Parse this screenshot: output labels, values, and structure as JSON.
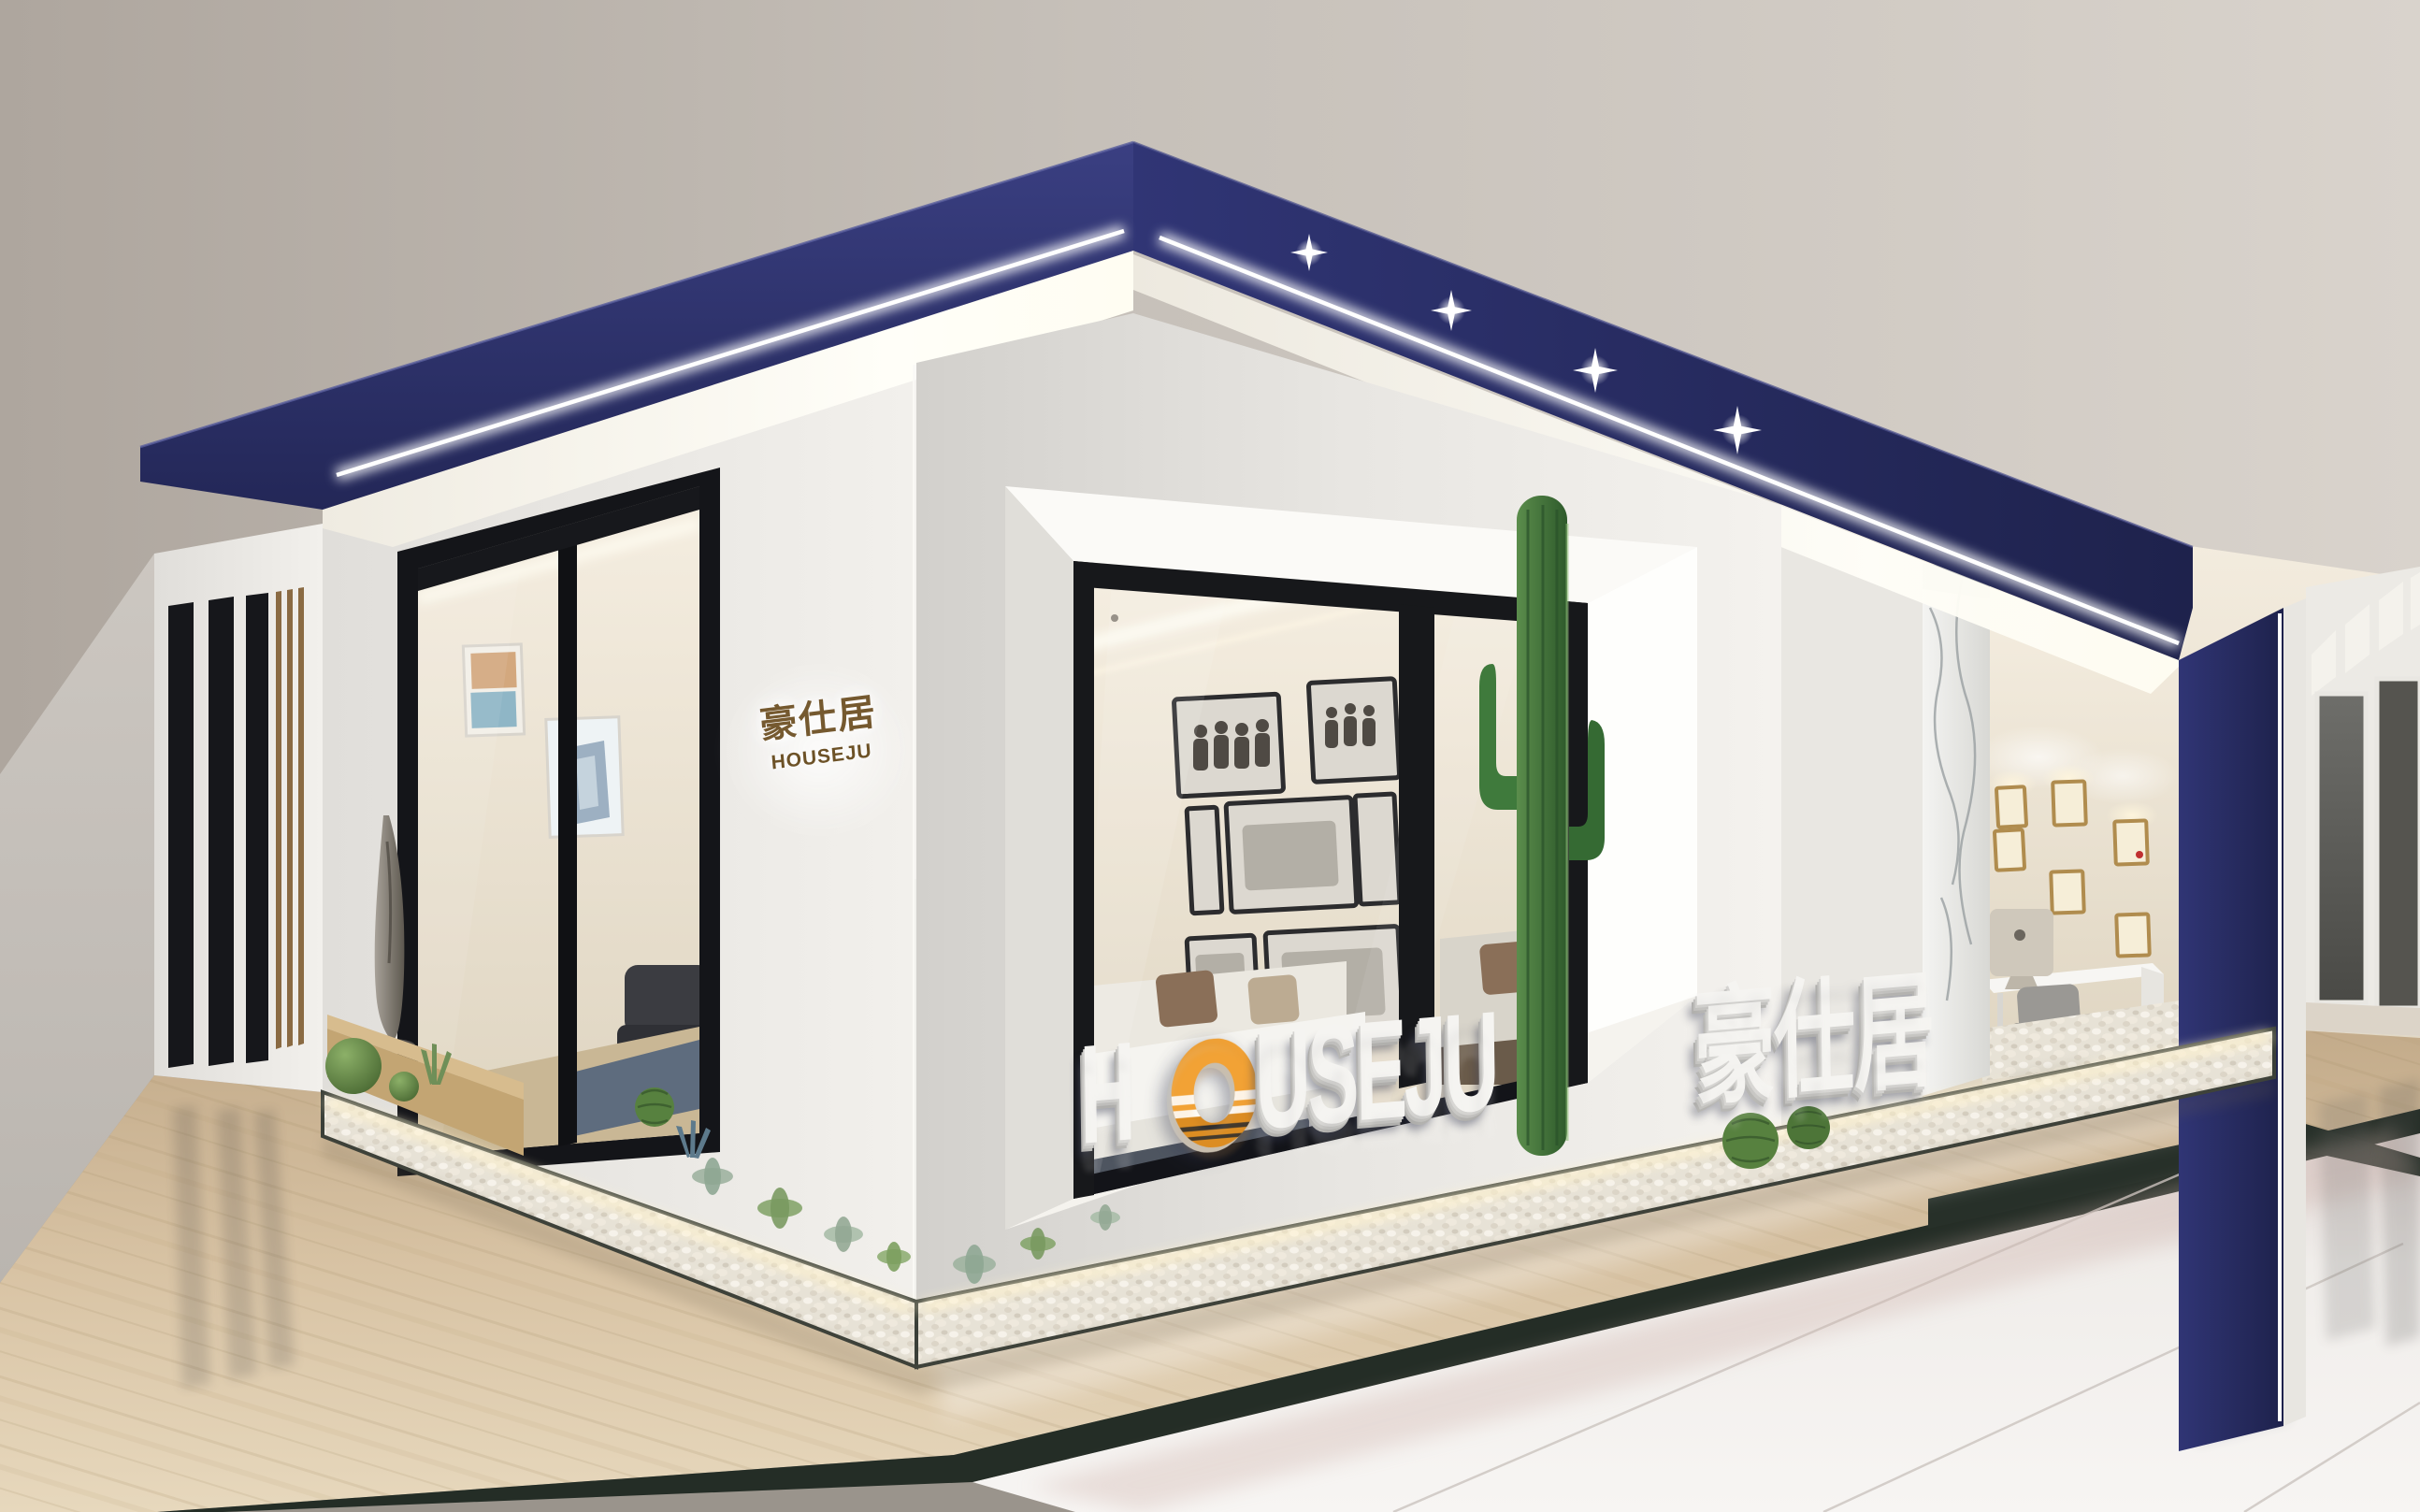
{
  "brand": {
    "name_en": "HOUSEJU",
    "name_cn": "豪仕居"
  },
  "wall_sign": {
    "cn": "豪仕居",
    "en": "HOUSEJU"
  },
  "watermark": {
    "h": "H",
    "o": "O",
    "rest": "USEJU",
    "cn": "豪仕居",
    "full": "HOUSEJU豪仕居"
  },
  "colors": {
    "navy": "#2a2e66",
    "navy_dark": "#20244e",
    "led": "#ffffff",
    "bronze": "#75592f",
    "orange": "#f2a235",
    "amber": "#d98a20",
    "facade": "#eceae6",
    "ceiling": "#c9c3bc",
    "floor_beige": "#d2bb9b",
    "floor_white": "#efece9",
    "marble_border": "#222c25",
    "plant_green": "#4c7a3c",
    "watermark_white": "#f5f4f1"
  }
}
